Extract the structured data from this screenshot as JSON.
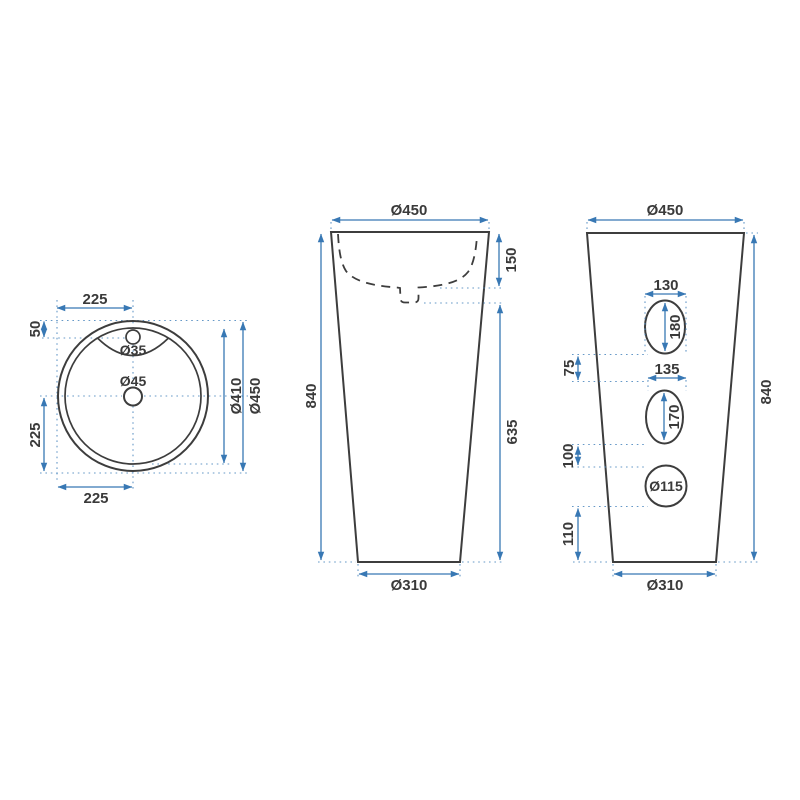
{
  "drawing": {
    "title": "Pedestal washbasin technical drawing",
    "colors": {
      "dimension_blue": "#3878b4",
      "outline_gray": "#3d3d3d",
      "text_gray": "#3a3a3a",
      "background": "#ffffff"
    },
    "views": {
      "top_view": {
        "labels": {
          "top_width": "225",
          "faucet_offset": "50",
          "left_height": "225",
          "bottom_width": "225",
          "faucet_hole": "Ø35",
          "drain_hole": "Ø45",
          "inner_diameter": "Ø410",
          "outer_diameter": "Ø450"
        }
      },
      "front_view": {
        "labels": {
          "top_diameter": "Ø450",
          "basin_depth": "150",
          "total_height": "840",
          "lower_height": "635",
          "bottom_diameter": "Ø310"
        }
      },
      "back_view": {
        "labels": {
          "top_diameter": "Ø450",
          "hole1_width": "130",
          "hole1_height": "180",
          "gap1": "75",
          "hole2_width": "135",
          "hole2_height": "170",
          "total_height": "840",
          "gap2": "100",
          "hole3_diameter": "Ø115",
          "gap3": "110",
          "bottom_diameter": "Ø310"
        }
      }
    }
  }
}
